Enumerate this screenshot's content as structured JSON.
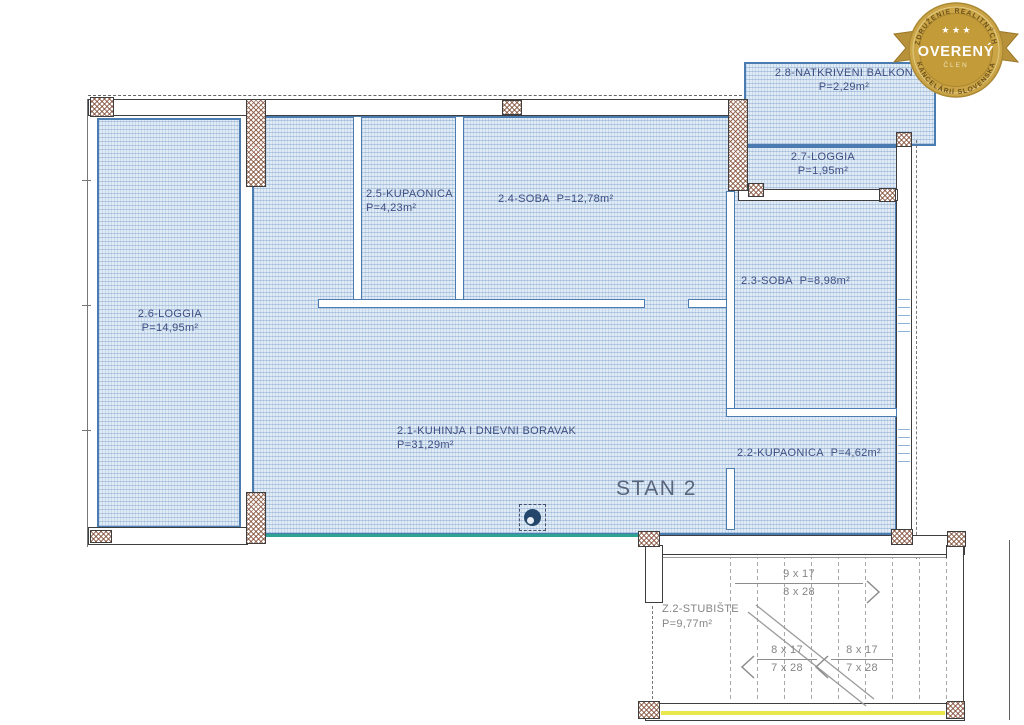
{
  "badge": {
    "arc_top": "ZDRUŽENIE REALITNÝCH",
    "arc_bottom": "KANCELÁRIÍ SLOVENSKA",
    "title": "OVERENÝ",
    "member": "ČLEN",
    "stars": "★ ★ ★",
    "colors": {
      "gold": "#c9a242",
      "gold_dark": "#a8842e",
      "title_text": "#ffffff"
    }
  },
  "plan": {
    "unit_title": "STAN 2",
    "rooms": [
      {
        "name": "2.8-NATKRIVENI BALKON",
        "area": "P=2,29m²"
      },
      {
        "name": "2.7-LOGGIA",
        "area": "P=1,95m²"
      },
      {
        "name": "2.5-KUPAONICA",
        "area": "P=4,23m²"
      },
      {
        "name": "2.4-SOBA",
        "area": "P=12,78m²"
      },
      {
        "name": "2.3-SOBA",
        "area": "P=8,98m²"
      },
      {
        "name": "2.6-LOGGIA",
        "area": "P=14,95m²"
      },
      {
        "name": "2.1-KUHINJA I DNEVNI BORAVAK",
        "area": "P=31,29m²"
      },
      {
        "name": "2.2-KUPAONICA",
        "area": "P=4,62m²"
      },
      {
        "name": "Z.2-STUBIŠTE",
        "area": "P=9,77m²"
      }
    ],
    "stairs": {
      "flight_up": {
        "top": "9 x 17",
        "bottom": "8 x 28"
      },
      "flight_left_a": {
        "top": "8 x 17",
        "bottom": "7 x 28"
      },
      "flight_left_b": {
        "top": "8 x 17",
        "bottom": "7 x 28"
      }
    },
    "colors": {
      "hatch_fill": "#e0ebf5",
      "hatch_border": "#4a7cb2",
      "wall_outline": "#3e3e3e",
      "label_text": "#3f4e82",
      "stair_text": "#858585",
      "terrace_edge_green": "#2ca393",
      "stair_edge_yellow": "#e9e74b"
    }
  }
}
